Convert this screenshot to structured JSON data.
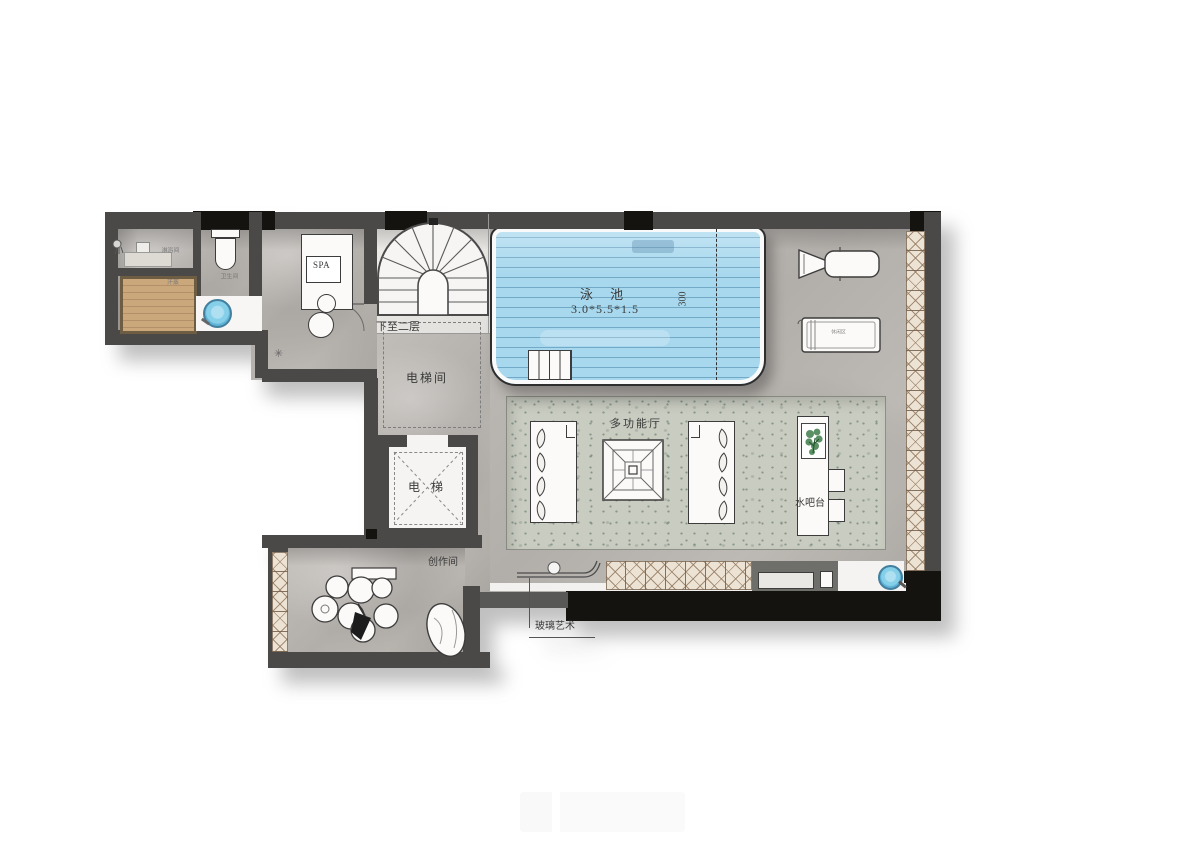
{
  "plan": {
    "pool": {
      "label": "泳 池",
      "dimensions": "3.0*5.5*1.5",
      "depth_mark": "300"
    },
    "stairs": {
      "note": "下至二层"
    },
    "elevator": {
      "hall_label": "电梯间",
      "cab_label": "电 梯"
    },
    "spa": {
      "label": "SPA"
    },
    "hall": {
      "label": "多功能厅"
    },
    "bar": {
      "label": "水吧台"
    },
    "studio": {
      "label": "创作间"
    },
    "glass_art": {
      "label": "玻璃艺术"
    },
    "lounge": {
      "chair_label": "休闲区"
    },
    "bath": {
      "shower_label": "淋浴间",
      "sauna_label": "汗蒸",
      "wc_label": "卫生间"
    }
  },
  "colors": {
    "wall": "#4b4947",
    "wall_black": "#15130f",
    "water_blue": "#a8d8ee",
    "wood": "#c8a478",
    "carpet": "#c9ccc1",
    "marble": "#b7b3ae",
    "hatch_line": "#967d64",
    "fixture_blue": "#86cfe9",
    "plant_green": "#3f7d4a"
  }
}
